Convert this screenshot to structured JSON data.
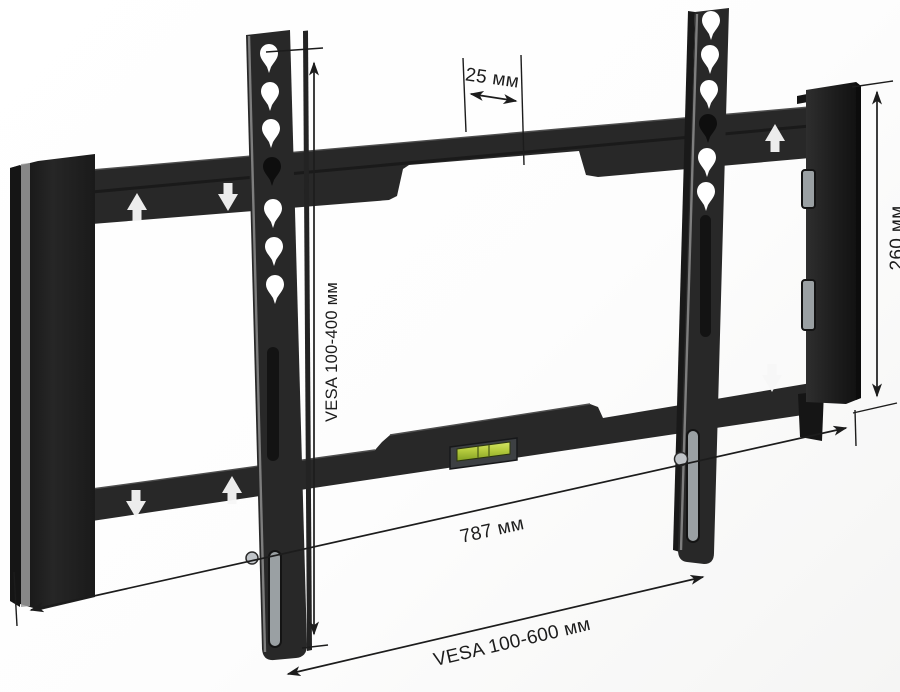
{
  "figure": {
    "type": "product-dimension-diagram",
    "subject": "Fixed TV wall mount bracket shown in perspective with measurement callouts",
    "background_color": "#ffffff"
  },
  "colors": {
    "metal_dark": "#282828",
    "metal_shadow": "#151515",
    "metal_highlight": "#9b9b9b",
    "annotation": "#1c1c1c",
    "level_green": "#b5cb3d",
    "screw_silver": "#c0c4c8"
  },
  "annotations": {
    "hook_spacing": {
      "label": "25 мм"
    },
    "vesa_vertical": {
      "label": "VESA 100-400 мм"
    },
    "bracket_height": {
      "label": "260 мм"
    },
    "overall_width": {
      "label": "787 мм"
    },
    "vesa_horizontal": {
      "label": "VESA 100-600 мм"
    }
  },
  "icons": {
    "up_arrow": "white up-arrow marking printed on wall rail",
    "down_arrow": "white down-arrow marking printed on wall rail",
    "bubble_level": "green spirit-level vial on lower rail",
    "mounting_hole": "teardrop VESA mounting hole",
    "adjustment_slot": "vertical adjustment slot"
  }
}
